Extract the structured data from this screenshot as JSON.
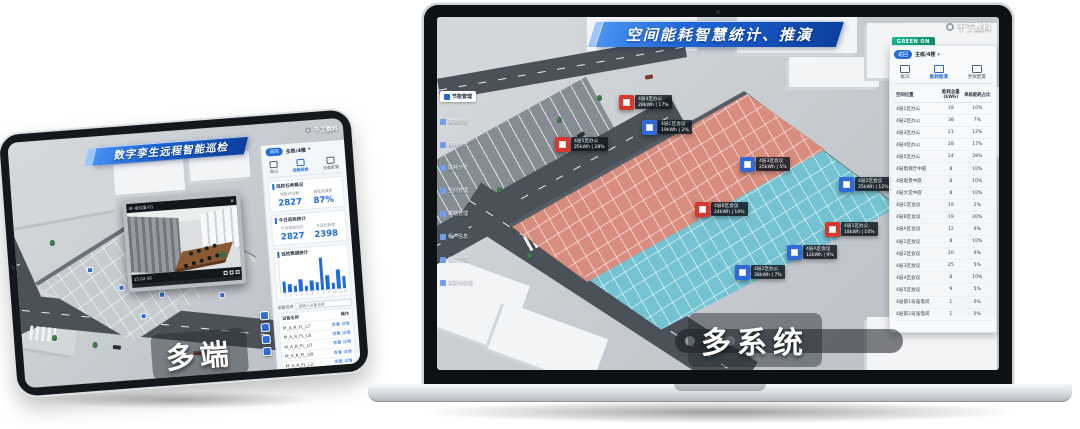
{
  "colors": {
    "accent": "#1f6bdc",
    "office_red": "#d63a2e",
    "meeting_blue": "#2f6bd8",
    "zone_office": "#d98d7e",
    "zone_meeting": "#74c3d2",
    "badge_green": "#17b890"
  },
  "tablet": {
    "title": "数字孪生远程智能巡检",
    "logo": "千丁数科",
    "overlay_label": "多端",
    "video": {
      "title": "4F-会议室-01",
      "close": "×",
      "time": "15:02:36"
    },
    "panel": {
      "back": "返回",
      "selector": "主栋/4楼",
      "chevron": "▾",
      "tabs": [
        {
          "label": "概况",
          "icon": "monitor"
        },
        {
          "label": "远程巡检",
          "icon": "patrol",
          "active": true
        },
        {
          "label": "设备配置",
          "icon": "gear"
        }
      ],
      "groups": [
        {
          "title": "巡检任务概况",
          "stats": [
            {
              "label": "巡检点位数",
              "value": "2827"
            },
            {
              "label": "巡检完成率",
              "value": "87%"
            }
          ]
        },
        {
          "title": "今日巡检统计",
          "stats": [
            {
              "label": "今日巡检点位",
              "value": "2827"
            },
            {
              "label": "今日已巡检",
              "value": "2398"
            }
          ]
        }
      ],
      "chart": {
        "type": "bar",
        "title": "巡检数据统计",
        "categories": [
          "1",
          "2",
          "3",
          "4",
          "5",
          "6",
          "7",
          "8",
          "9",
          "10",
          "11",
          "12"
        ],
        "values": [
          34,
          25,
          20,
          38,
          16,
          30,
          25,
          100,
          43,
          20,
          59,
          38
        ]
      },
      "filter_label": "设备名称",
      "filter_placeholder": "请输入设备名称",
      "list": {
        "headers": {
          "name": "设备名称",
          "action": "操作"
        },
        "rows": [
          {
            "name": "M_A_R_FL_L7",
            "action": "查看 详情"
          },
          {
            "name": "M_A_R_FL_L8",
            "action": "查看 详情"
          },
          {
            "name": "M_A_R_FL_U7",
            "action": "查看 详情"
          },
          {
            "name": "M_A_R_FL_U9",
            "action": "查看 详情"
          },
          {
            "name": "M_A_R_FL_L2",
            "action": "查看 详情"
          },
          {
            "name": "M_A_R_FL_L9",
            "action": "查看 详情"
          },
          {
            "name": "M_A_R_FL_L3",
            "action": "查看 详情"
          },
          {
            "name": "M_A_R_FL_L6",
            "action": "查看 详情"
          }
        ]
      }
    }
  },
  "laptop": {
    "title": "空间能耗智慧统计、推演",
    "logo": "千丁数科",
    "green_badge": "GREEN ON",
    "overlay_label": "多系统",
    "sidebar": {
      "items": [
        {
          "label": "节能管理",
          "active": true
        },
        {
          "label": "数据概览"
        },
        {
          "label": "能耗统计"
        },
        {
          "label": "能耗分析"
        },
        {
          "label": "空间管理"
        },
        {
          "label": "策略管理"
        },
        {
          "label": "租户信息"
        },
        {
          "label": "缴费管理"
        },
        {
          "label": "变配电管理"
        }
      ]
    },
    "panel": {
      "back": "返回",
      "selector": "主栋/4楼",
      "chevron": "▾",
      "tabs": [
        {
          "label": "概况",
          "icon": "monitor"
        },
        {
          "label": "能耗推演",
          "icon": "flow",
          "active": true
        },
        {
          "label": "参数配置",
          "icon": "gear"
        }
      ],
      "table": {
        "headers": [
          "空间位置",
          "能耗总量 (kWh)",
          "单栋能耗占比"
        ],
        "rows": [
          [
            "4层1区办公",
            "18",
            "10%"
          ],
          [
            "4层2区办公",
            "38",
            "7%"
          ],
          [
            "4层3区办公",
            "21",
            "12%"
          ],
          [
            "4层4区办公",
            "28",
            "17%"
          ],
          [
            "4层5区办公",
            "24",
            "28%"
          ],
          [
            "4层电梯厅中庭",
            "8",
            "10%"
          ],
          [
            "4层观景中庭",
            "8",
            "10%"
          ],
          [
            "4层大堂中庭",
            "8",
            "10%"
          ],
          [
            "4层C区会议",
            "19",
            "2%"
          ],
          [
            "4层B区会议",
            "19",
            "20%"
          ],
          [
            "4层A区会议",
            "12",
            "9%"
          ],
          [
            "4层1区会议",
            "8",
            "10%"
          ],
          [
            "4层2区会议",
            "20",
            "9%"
          ],
          [
            "4层3区会议",
            "25",
            "5%"
          ],
          [
            "4层4区会议",
            "8",
            "10%"
          ],
          [
            "4层5区会议",
            "9",
            "5%"
          ],
          [
            "4层第1号强电间",
            "1",
            "0%"
          ],
          [
            "4层第2号强电间",
            "1",
            "0%"
          ]
        ]
      }
    },
    "map_labels": [
      {
        "name": "4层4区办公",
        "value": "28kWh | 17%",
        "type": "red",
        "x": 182,
        "y": 78
      },
      {
        "name": "4层C区会议",
        "value": "19kWh | 2%",
        "type": "blue",
        "x": 205,
        "y": 103
      },
      {
        "name": "4层5区办公",
        "value": "25kWh | 28%",
        "type": "red",
        "x": 118,
        "y": 120
      },
      {
        "name": "4层3区会议",
        "value": "25kWh | 5%",
        "type": "blue",
        "x": 303,
        "y": 140
      },
      {
        "name": "4层B区会议",
        "value": "24kWh | 10%",
        "type": "red",
        "x": 258,
        "y": 185
      },
      {
        "name": "4层2区会议",
        "value": "25kWh | 12%",
        "type": "blue",
        "x": 402,
        "y": 160
      },
      {
        "name": "4层1区办公",
        "value": "18kWh | 10%",
        "type": "red",
        "x": 388,
        "y": 205
      },
      {
        "name": "4层A区会议",
        "value": "12kWh | 9%",
        "type": "blue",
        "x": 350,
        "y": 228
      },
      {
        "name": "4层2区办公",
        "value": "38kWh | 7%",
        "type": "blue",
        "x": 298,
        "y": 248
      }
    ]
  }
}
